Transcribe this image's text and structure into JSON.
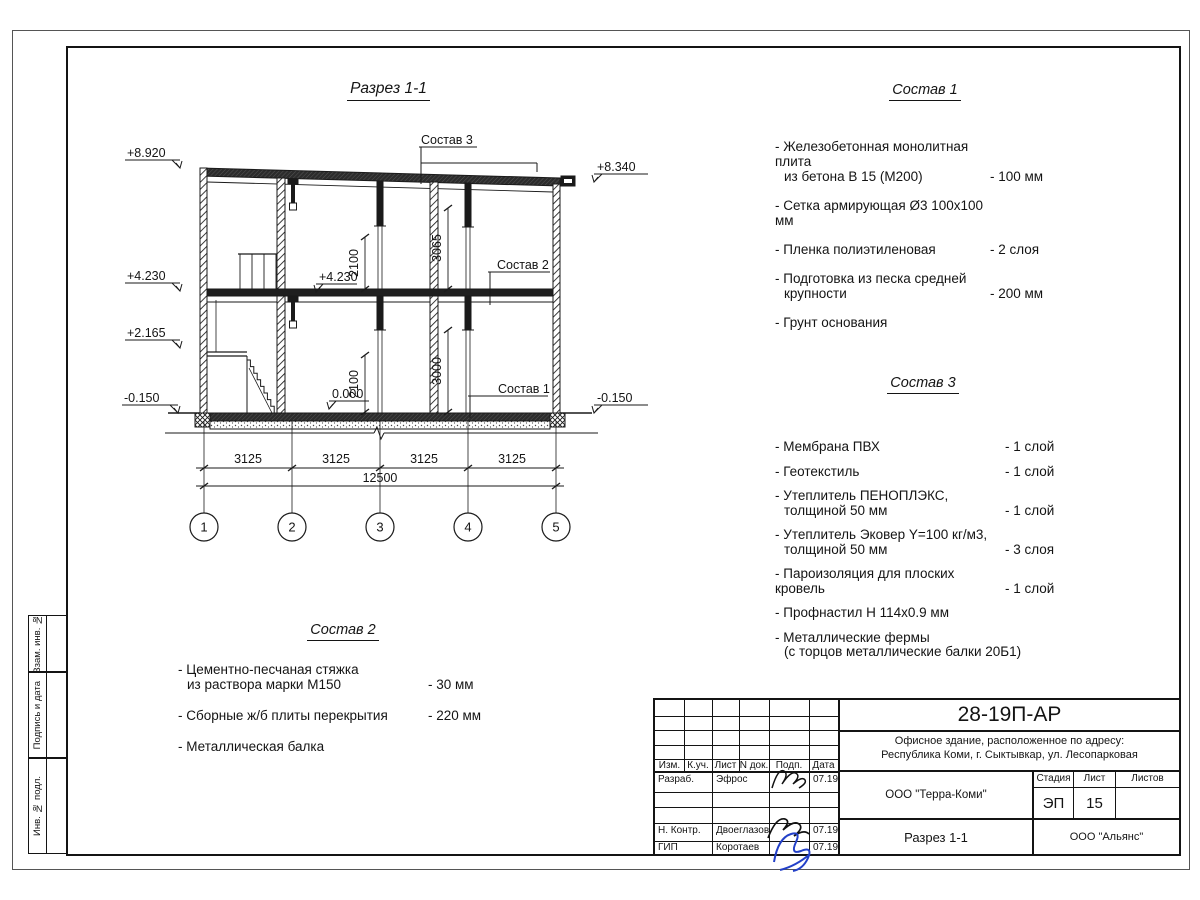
{
  "drawing": {
    "title": "Разрез 1-1",
    "marks": {
      "m8920": "+8.920",
      "m8340": "+8.340",
      "m4230_left": "+4.230",
      "m2165": "+2.165",
      "m0150_left": "-0.150",
      "m0150_right": "-0.150",
      "m4230_inner": "+4.230",
      "m0000": "0.000"
    },
    "dims": {
      "bay": "3125",
      "total": "12500",
      "h2100_upper": "2100",
      "h3065": "3065",
      "h2100_lower": "2100",
      "h3000": "3000"
    },
    "axes": [
      "1",
      "2",
      "3",
      "4",
      "5"
    ],
    "callouts": {
      "sostav1": "Состав 1",
      "sostav2": "Состав 2",
      "sostav3": "Состав 3"
    }
  },
  "sostav1": {
    "title": "Состав 1",
    "items": [
      {
        "name": "- Железобетонная  монолитная плита",
        "name2": "из бетона В 15 (М200)",
        "value": "- 100 мм"
      },
      {
        "name": "- Сетка армирующая Ø3 100х100 мм"
      },
      {
        "name": "- Пленка полиэтиленовая",
        "value": "-  2 слоя"
      },
      {
        "name": "- Подготовка из песка средней",
        "name2": "крупности",
        "value": "- 200 мм"
      },
      {
        "name": "- Грунт основания"
      }
    ]
  },
  "sostav2": {
    "title": "Состав 2",
    "items": [
      {
        "name": "- Цементно-песчаная стяжка",
        "name2": "из раствора марки М150",
        "value": "- 30 мм"
      },
      {
        "name": "- Сборные ж/б плиты перекрытия",
        "value": "- 220 мм"
      },
      {
        "name": "- Металлическая балка"
      }
    ]
  },
  "sostav3": {
    "title": "Состав 3",
    "items": [
      {
        "name": "- Мембрана ПВХ",
        "value": "- 1 слой"
      },
      {
        "name": "- Геотекстиль",
        "value": "- 1 слой"
      },
      {
        "name": "- Утеплитель ПЕНОПЛЭКС,",
        "name2": "толщиной 50 мм",
        "value": "- 1 слой"
      },
      {
        "name": "- Утеплитель Эковер Y=100 кг/м3,",
        "name2": "толщиной 50 мм",
        "value": "- 3 слоя"
      },
      {
        "name": "- Пароизоляция для плоских кровель",
        "value": "- 1 слой"
      },
      {
        "name": "- Профнастил Н 114х0.9 мм"
      },
      {
        "name": "- Металлические фермы",
        "name2": "(с торцов металлические балки 20Б1)"
      }
    ]
  },
  "titleblock": {
    "doc_number": "28-19П-АР",
    "object_line1": "Офисное здание, расположенное по адресу:",
    "object_line2": "Республика Коми, г. Сыктывкар, ул. Лесопарковая",
    "org": "ООО \"Терра-Коми\"",
    "stage_label": "Стадия",
    "stage": "ЭП",
    "sheet_label": "Лист",
    "sheet": "15",
    "sheets_label": "Листов",
    "sheets": "",
    "drawing_name": "Разрез 1-1",
    "contractor": "ООО \"Альянс\"",
    "cols": {
      "izm": "Изм.",
      "kuch": "К.уч.",
      "list": "Лист",
      "ndok": "N док.",
      "podp": "Подп.",
      "data": "Дата"
    },
    "rows": [
      {
        "role": "Разраб.",
        "name": "Эфрос",
        "date": "07.19"
      },
      {
        "role": "Н. Контр.",
        "name": "Двоеглазов",
        "date": "07.19"
      },
      {
        "role": "ГИП",
        "name": "Коротаев",
        "date": "07.19"
      }
    ]
  },
  "stamps": {
    "zam": "Взам. инв. №",
    "podpis": "Подпись и дата",
    "inv": "Инв. № подл."
  }
}
